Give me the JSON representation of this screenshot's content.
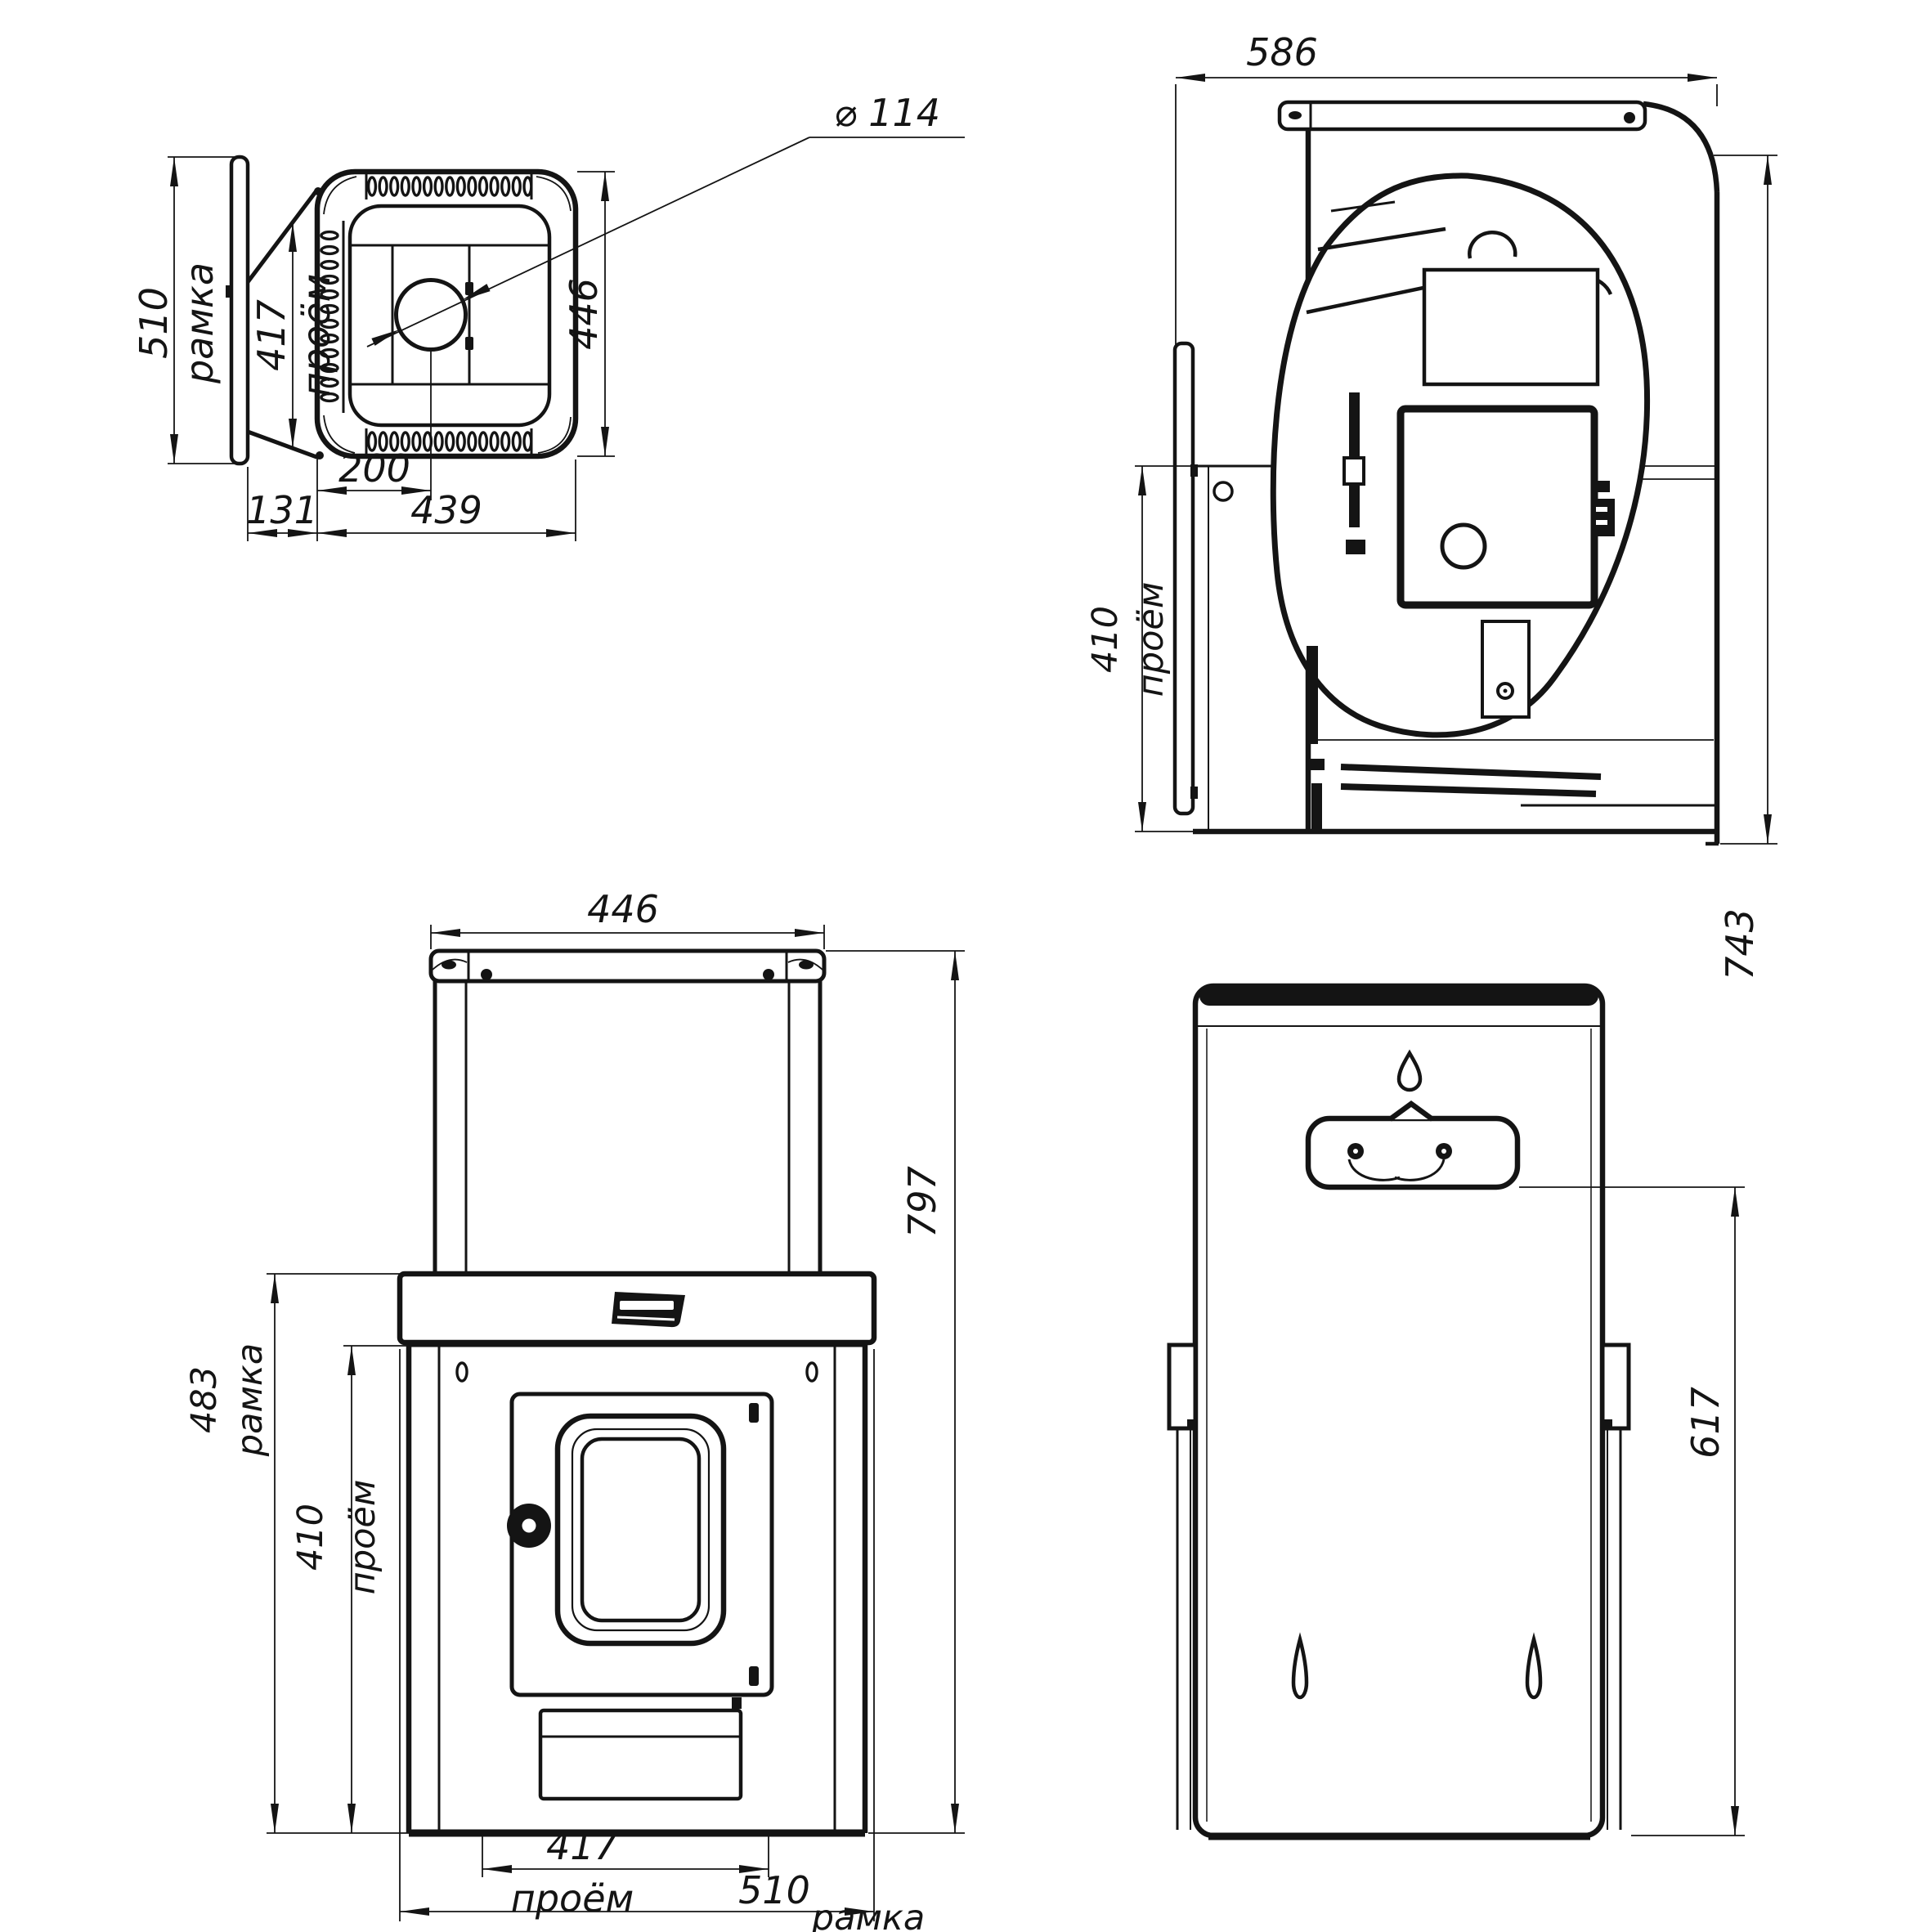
{
  "colors": {
    "background": "#ffffff",
    "ink": "#141414"
  },
  "labels": {
    "plan": {
      "frame_value": "510",
      "frame_word": "рамка",
      "opening_value": "417",
      "opening_word": "проём",
      "diameter": "⌀ 114",
      "depth_value": "446",
      "offset_value": "200",
      "gap_value": "131",
      "body_value": "439"
    },
    "side": {
      "total_depth": "586",
      "opening_value": "410",
      "opening_word": "проём",
      "total_height": "743"
    },
    "front": {
      "width_value": "446",
      "height_value": "797",
      "frame_h_value": "483",
      "frame_h_word": "рамка",
      "opening_h_value": "410",
      "opening_h_word": "проём",
      "opening_w_value": "417",
      "opening_w_word": "проём",
      "frame_w_value": "510",
      "frame_w_word": "рамка"
    },
    "rear": {
      "mount_value": "617"
    }
  }
}
